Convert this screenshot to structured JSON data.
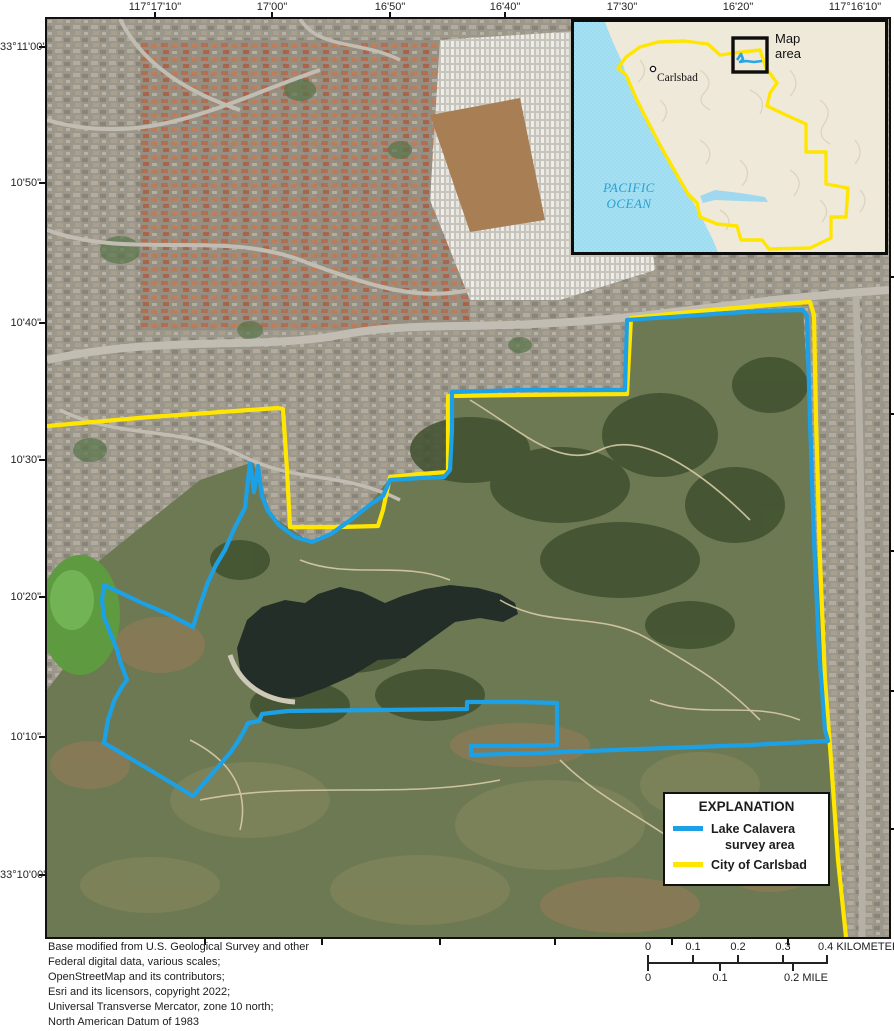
{
  "figure": {
    "type": "usgs-map-figure",
    "subject": "Lake Calavera survey area, Carlsbad, California"
  },
  "axes": {
    "top_labels": [
      "117°17'10\"",
      "17'00\"",
      "16'50\"",
      "16'40\"",
      "17'30\"",
      "16'20\"",
      "117°16'10\""
    ],
    "left_labels": [
      "33°11'00\"",
      "10'50\"",
      "10'40\"",
      "10'30\"",
      "10'20\"",
      "10'10\"",
      "33°10'00\""
    ]
  },
  "inset": {
    "map_area_label": "Map area",
    "city": "Carlsbad",
    "ocean": "PACIFIC OCEAN"
  },
  "legend": {
    "title": "EXPLANATION",
    "items": [
      {
        "label": "Lake Calavera survey area",
        "color": "#1da1e6"
      },
      {
        "label": "City of Carlsbad",
        "color": "#ffe600"
      }
    ]
  },
  "scalebar": {
    "km_labels": [
      "0",
      "0.1",
      "0.2",
      "0.3"
    ],
    "km_end_label": "0.4 KILOMETER",
    "mile_labels": [
      "0",
      "0.1"
    ],
    "mile_end_label": "0.2 MILE"
  },
  "credits": [
    "Base modified from U.S. Geological Survey and other",
    "Federal digital data, various scales;",
    "OpenStreetMap and its contributors;",
    "Esri and its licensors, copyright 2022;",
    "Universal Transverse Mercator, zone 10 north;",
    "North American Datum of 1983"
  ],
  "colors": {
    "survey_line": "#1da1e6",
    "city_line": "#ffe600"
  }
}
